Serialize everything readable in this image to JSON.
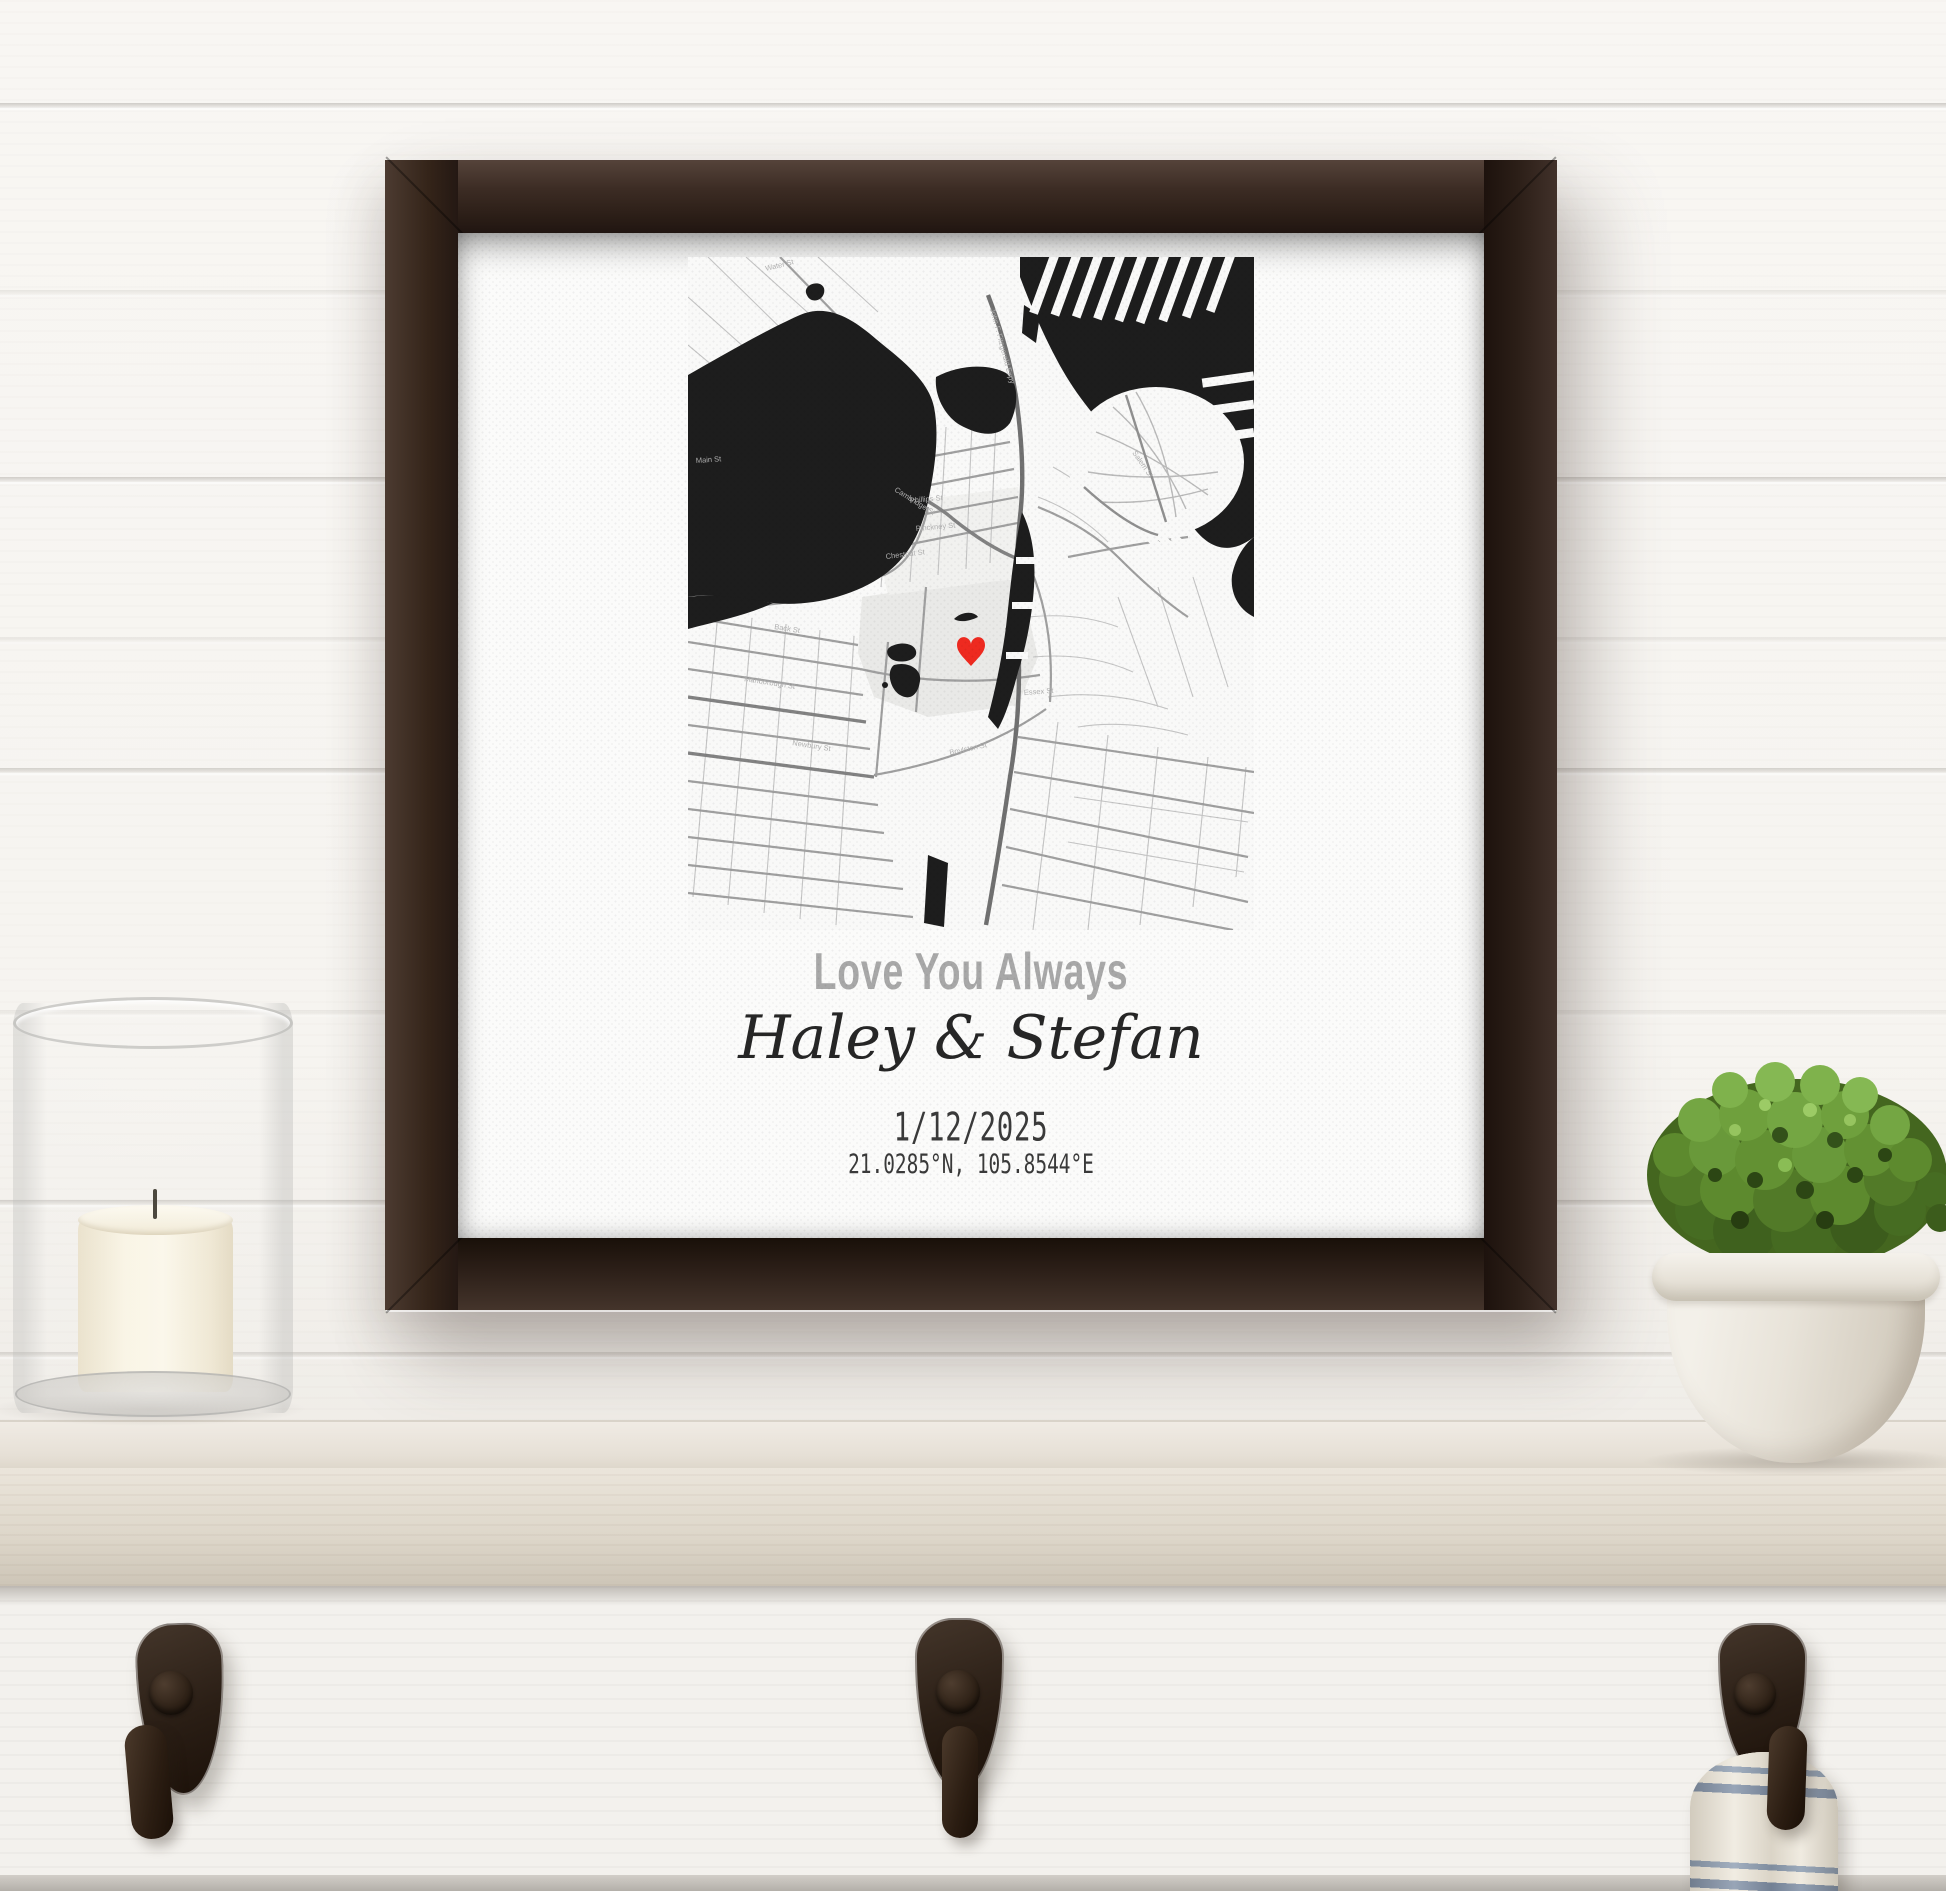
{
  "print": {
    "headline": "Love You Always",
    "names": "Haley & Stefan",
    "date": "1/12/2025",
    "coordinates": "21.0285°N, 105.8544°E"
  },
  "map": {
    "marker_icon": "heart-marker-icon",
    "marker_color": "#ee2a20",
    "water_color": "#1d1d1d",
    "land_color": "#f9f9f8",
    "park_color": "#e9e9e7",
    "street_color": "#9f9f9f",
    "labels": [
      {
        "text": "Water St"
      },
      {
        "text": "Main St"
      },
      {
        "text": "John F. Fitzgerald Expy"
      },
      {
        "text": "Phillips St"
      },
      {
        "text": "Pinckney St"
      },
      {
        "text": "Chestnut St"
      },
      {
        "text": "Cambridge St"
      },
      {
        "text": "Salem St"
      },
      {
        "text": "Back St"
      },
      {
        "text": "Marlborough St"
      },
      {
        "text": "Newbury St"
      },
      {
        "text": "Boylston St"
      },
      {
        "text": "Essex St"
      }
    ]
  },
  "scene": {
    "frame_color": "#31251e",
    "wall_color": "#f6f4f0",
    "shelf_color": "#e7e1d8",
    "hook_color": "#2e231b",
    "towel_stripe_color": "#8495ab",
    "candle_color": "#f7f1e2",
    "plant_color": "#5d8a33",
    "pot_color": "#eceae3"
  }
}
